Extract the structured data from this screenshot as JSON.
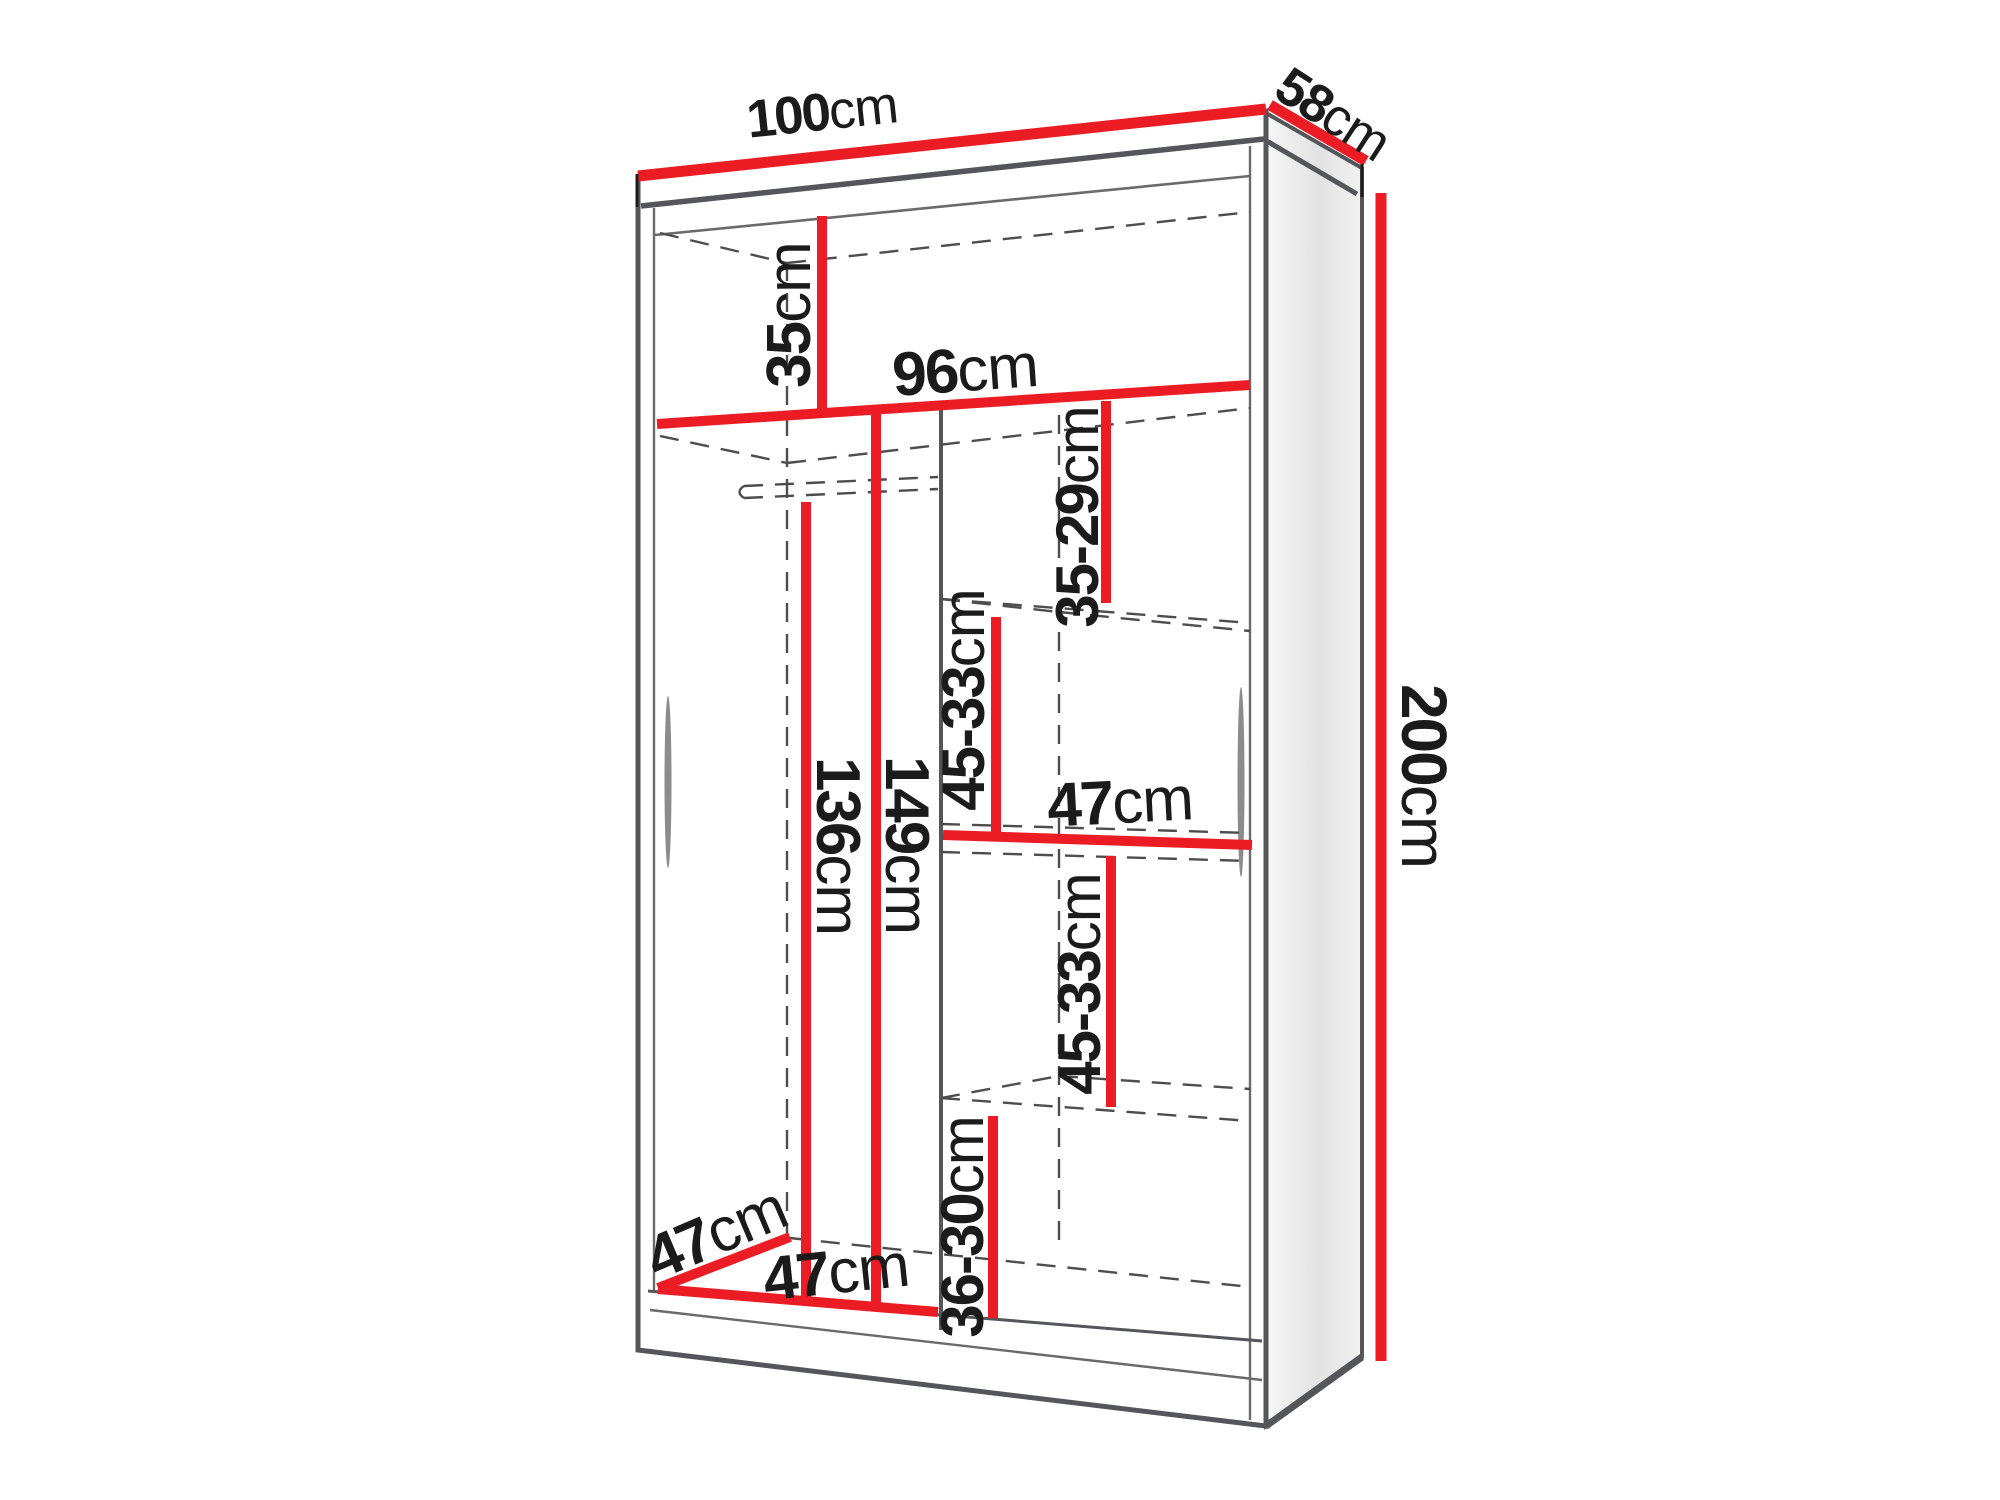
{
  "diagram": {
    "type": "wardrobe-dimension-diagram",
    "unit": "cm",
    "colors": {
      "dimension_red": "#ec1c24",
      "outline_gray": "#55565a",
      "dash_gray": "#4d4d4d",
      "text_black": "#1b1b1b",
      "background": "#ffffff"
    },
    "dimensions": {
      "total_width": {
        "value": "100",
        "unit": "cm"
      },
      "total_depth": {
        "value": "58",
        "unit": "cm"
      },
      "total_height": {
        "value": "200",
        "unit": "cm"
      },
      "top_shelf_height": {
        "value": "35",
        "unit": "cm"
      },
      "interior_width": {
        "value": "96",
        "unit": "cm"
      },
      "right_top_compartment": {
        "value": "35-29",
        "unit": "cm"
      },
      "right_upper_compartment": {
        "value": "45-33",
        "unit": "cm"
      },
      "right_section_width": {
        "value": "47",
        "unit": "cm"
      },
      "right_lower_compartment": {
        "value": "45-33",
        "unit": "cm"
      },
      "right_bottom_compartment": {
        "value": "36-30",
        "unit": "cm"
      },
      "hanging_space_height": {
        "value": "136",
        "unit": "cm"
      },
      "left_section_height": {
        "value": "149",
        "unit": "cm"
      },
      "interior_depth": {
        "value": "47",
        "unit": "cm"
      },
      "left_section_width": {
        "value": "47",
        "unit": "cm"
      }
    }
  }
}
